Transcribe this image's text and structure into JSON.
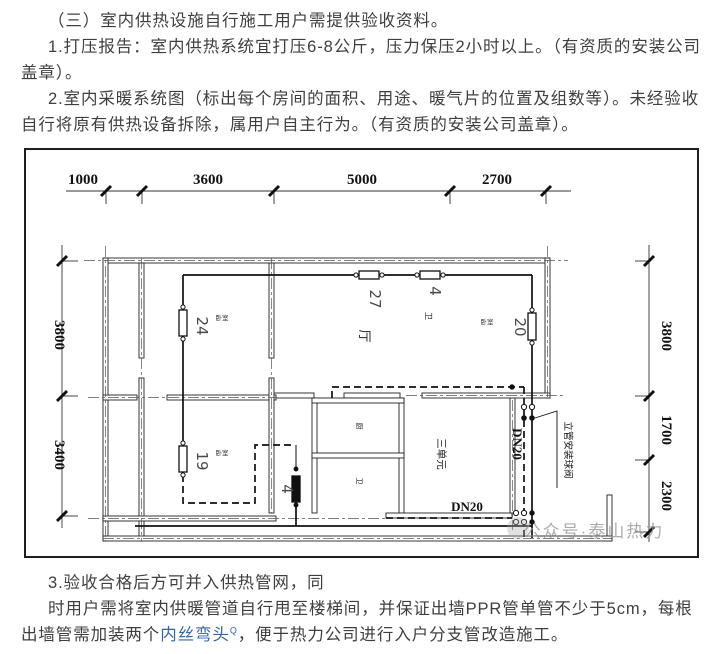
{
  "document": {
    "paragraphs": {
      "p1": "（三）室内供热设施自行施工用户需提供验收资料。",
      "p2": "1.打压报告：室内供热系统宜打压6-8公斤，压力保压2小时以上。（有资质的安装公司盖章）。",
      "p3": "2.室内采暖系统图（标出每个房间的面积、用途、暖气片的位置及组数等）。未经验收自行将原有供热设备拆除，属用户自主行为。（有资质的安装公司盖章）。",
      "p4": "3.验收合格后方可并入供热管网，同",
      "p5_before": "时用户需将室内供暖管道自行甩至楼梯间，并保证出墙PPR管单管不少于5cm，每根出墙管需加装两个",
      "p5_link": "内丝弯头",
      "p5_link_sup": "Q",
      "p5_after": "，便于热力公司进行入户分支管改造施工。"
    }
  },
  "floor_plan": {
    "dimensions": {
      "top": [
        "1000",
        "3600",
        "5000",
        "2700"
      ],
      "left": [
        "3800",
        "3400"
      ],
      "right": [
        "3800",
        "1700",
        "2300"
      ]
    },
    "radiators": {
      "r24": "24",
      "r27": "27",
      "r4_top": "4",
      "r20": "20",
      "r19": "19",
      "r4_mid": "4"
    },
    "rooms": {
      "hall": "厅",
      "bath_top": "卫",
      "kitchen": "厨",
      "bath_mid": "卫",
      "bedroom_tl": "卧室",
      "bedroom_tr": "卧室",
      "bedroom_bl": "卧室",
      "unit": "三单元"
    },
    "pipes": {
      "riser_label": "DN20",
      "bottom_label": "DN20"
    },
    "annotations": {
      "valve_note": "立管安装球阀"
    },
    "watermark": "公众号·泰山热力"
  }
}
